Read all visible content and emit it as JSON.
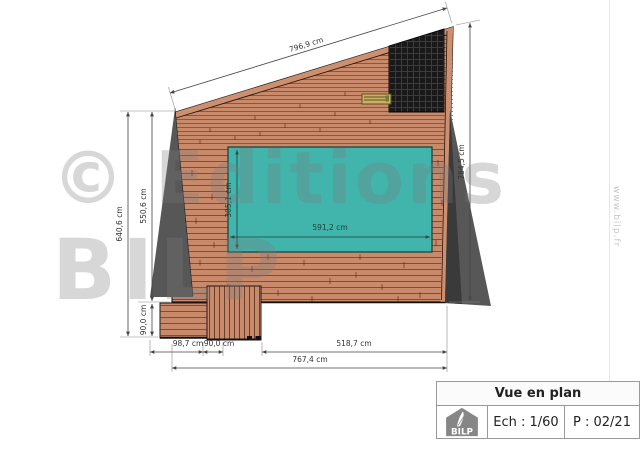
{
  "drawing": {
    "dimensions": {
      "top_slope": "796,9 cm",
      "right_height": "784,5 cm",
      "left_total": "640,6 cm",
      "left_upper": "550,6 cm",
      "left_lower": "90,0 cm",
      "bottom_step1": "98,7 cm",
      "bottom_step2": "90,0 cm",
      "bottom_right": "518,7 cm",
      "bottom_total": "767,4 cm",
      "pool_width": "591,2 cm",
      "pool_height": "305,1 cm"
    },
    "colors": {
      "wood": "#c98a6b",
      "wood_edge": "#cc9070",
      "pool": "#41b5ac",
      "shadow": "#575757",
      "panel": "#191919",
      "hatch": "#c9b063"
    }
  },
  "watermark": {
    "line1": "© Editions",
    "line2": "BILP",
    "website": "www.bilp.fr"
  },
  "title_block": {
    "title": "Vue en plan",
    "scale_label": "Ech : 1/60",
    "page_label": "P : 02/21",
    "logo_text": "BILP"
  }
}
